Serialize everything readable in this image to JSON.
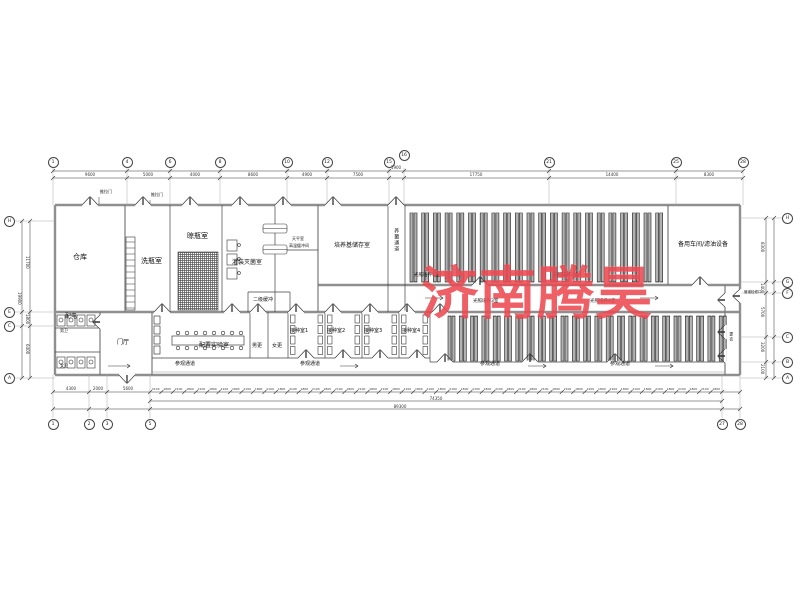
{
  "watermark": {
    "text": "济南腾昊",
    "color": "#ec4a52"
  },
  "rooms": {
    "warehouse": "仓库",
    "bottle_wash": "洗瓶室",
    "bottle_dry": "晾瓶室",
    "filling_steril": "灌装灭菌室",
    "balance": "天平室",
    "hot_buffer": "高温缓冲间",
    "medium_storage": "培养基储存室",
    "fungus_corridor": "养菌通道",
    "light_culture_1": "光照培养1室",
    "light_culture_2": "光照培养2室",
    "light_culture_3": "光照培养3室",
    "light_culture_4": "光照培养4室",
    "spare_workshop": "备用车间/滤油设备",
    "secondary_buffer": "二级缓冲",
    "prep_lab": "配置实验室",
    "men_change": "男更",
    "women_change": "女更",
    "inoculation_1": "接种室1",
    "inoculation_2": "接种室2",
    "inoculation_3": "接种室3",
    "inoculation_4": "接种室4",
    "power": "配电",
    "men_wc": "男卫",
    "women_wc": "女卫",
    "foyer": "门厅",
    "change": "更衣",
    "visit_corridor": "参观通道",
    "sliding_door": "推拉门",
    "pipe_access": "管道检修口"
  },
  "grid": {
    "top": [
      "1",
      "4",
      "6",
      "8",
      "10",
      "12",
      "15",
      "16",
      "21",
      "25",
      "28"
    ],
    "bottom": [
      "1",
      "2",
      "3",
      "5",
      "27",
      "28"
    ],
    "left": [
      "H",
      "E",
      "C",
      "A"
    ],
    "right": [
      "H",
      "G",
      "F",
      "C",
      "B",
      "A"
    ]
  },
  "dims": {
    "top": [
      "9600",
      "5000",
      "4000",
      "8600",
      "4900",
      "7500",
      "1900",
      "17750",
      "14400",
      "8300"
    ],
    "bottom_left": [
      "4300",
      "2000",
      "5600"
    ],
    "bottom_mid_total": "74350",
    "bottom_total": "89300",
    "left": [
      "11700",
      "1800",
      "6400"
    ],
    "left_total": "19900",
    "right": [
      "8300",
      "1400",
      "5700",
      "3200",
      "2100"
    ],
    "tick_pattern": [
      "2100",
      "1800"
    ]
  },
  "racks": {
    "upper_count": 22,
    "lower_count": 25
  }
}
